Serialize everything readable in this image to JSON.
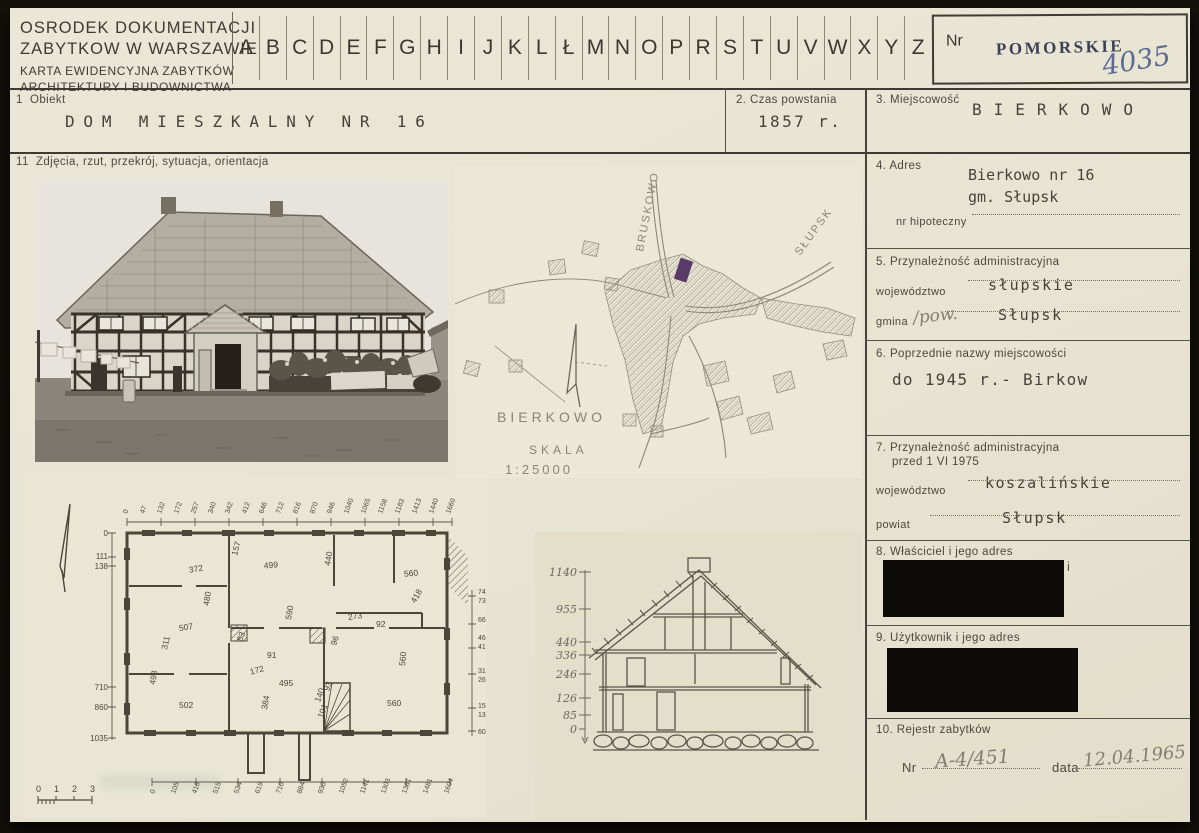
{
  "header": {
    "org_line1": "OSRODEK DOKUMENTACJI",
    "org_line2": "ZABYTKOW W WARSZAWIE",
    "org_line3": "KARTA EWIDENCYJNA ZABYTKÓW",
    "org_line4": "ARCHITEKTURY I BUDOWNICTWA"
  },
  "alphabet": [
    "A",
    "B",
    "C",
    "D",
    "E",
    "F",
    "G",
    "H",
    "I",
    "J",
    "K",
    "L",
    "Ł",
    "M",
    "N",
    "O",
    "P",
    "R",
    "S",
    "T",
    "U",
    "V",
    "W",
    "X",
    "Y",
    "Z"
  ],
  "nr": {
    "label": "Nr",
    "stamp": "POMORSKIE",
    "number": "4035"
  },
  "f1": {
    "label": "1  Obiekt",
    "value": "DOM MIESZKALNY NR 16"
  },
  "f2": {
    "label": "2. Czas powstania",
    "value": "1857 r."
  },
  "f3": {
    "label": "3. Miejscowość",
    "value": "BIERKOWO"
  },
  "f4": {
    "label": "4. Adres",
    "line1": "Bierkowo nr 16",
    "line2": "gm. Słupsk",
    "sub_label": "nr hipoteczny"
  },
  "f5": {
    "label": "5. Przynależność administracyjna",
    "row1_label": "województwo",
    "row1_value": "słupskie",
    "row2_label": "gmina",
    "row2_hand": "/pow.",
    "row2_value": "Słupsk"
  },
  "f6": {
    "label": "6. Poprzednie nazwy miejscowości",
    "value": "do 1945 r.- Birkow"
  },
  "f7": {
    "label_line1": "7. Przynależność administracyjna",
    "label_line2": "przed 1 VI 1975",
    "row1_label": "województwo",
    "row1_value": "koszalińskie",
    "row2_label": "powiat",
    "row2_value": "Słupsk"
  },
  "f8": {
    "label": "8. Właściciel i jego adres",
    "remnant": "i"
  },
  "f9": {
    "label": "9. Użytkownik i jego adres"
  },
  "f10": {
    "label": "10. Rejestr zabytków",
    "nr_label": "Nr",
    "nr_value": "A-4/451",
    "date_label": "data",
    "date_value": "12.04.1965"
  },
  "f11": {
    "label": "11  Zdjęcia, rzut, przekrój, sytuacja, orientacja"
  },
  "map": {
    "road_top": "BRUSKOWO",
    "road_right": "SŁUPSK",
    "village": "BIERKOWO",
    "scale_word": "SKALA",
    "scale_value": "1:25000"
  },
  "plan": {
    "left_scale": [
      "0",
      "111",
      "138",
      "710",
      "860",
      "1035"
    ],
    "right_scale": [
      "741",
      "736",
      "668",
      "468",
      "416",
      "312",
      "268",
      "154",
      "132",
      "60"
    ],
    "top_dims": [
      "0",
      "47",
      "132",
      "172",
      "257",
      "340",
      "342",
      "412",
      "646",
      "712",
      "816",
      "870",
      "946",
      "1040",
      "1065",
      "1158",
      "1183",
      "1413",
      "1440",
      "1660"
    ],
    "bottom_dims": [
      "0",
      "105",
      "416",
      "515",
      "534",
      "619",
      "710",
      "884",
      "930",
      "1052",
      "1141",
      "1303",
      "1361",
      "1481",
      "1604"
    ],
    "room_dims": [
      "372",
      "480",
      "507",
      "311",
      "498",
      "502",
      "157",
      "499",
      "590",
      "83",
      "91",
      "172",
      "384",
      "495",
      "440",
      "96",
      "273",
      "92",
      "418",
      "560",
      "560",
      "560",
      "93",
      "140",
      "101"
    ],
    "scalebar": [
      "0",
      "1",
      "2",
      "3"
    ]
  },
  "section": {
    "scale": [
      "1140",
      "955",
      "440",
      "336",
      "246",
      "126",
      "85",
      "0"
    ]
  }
}
